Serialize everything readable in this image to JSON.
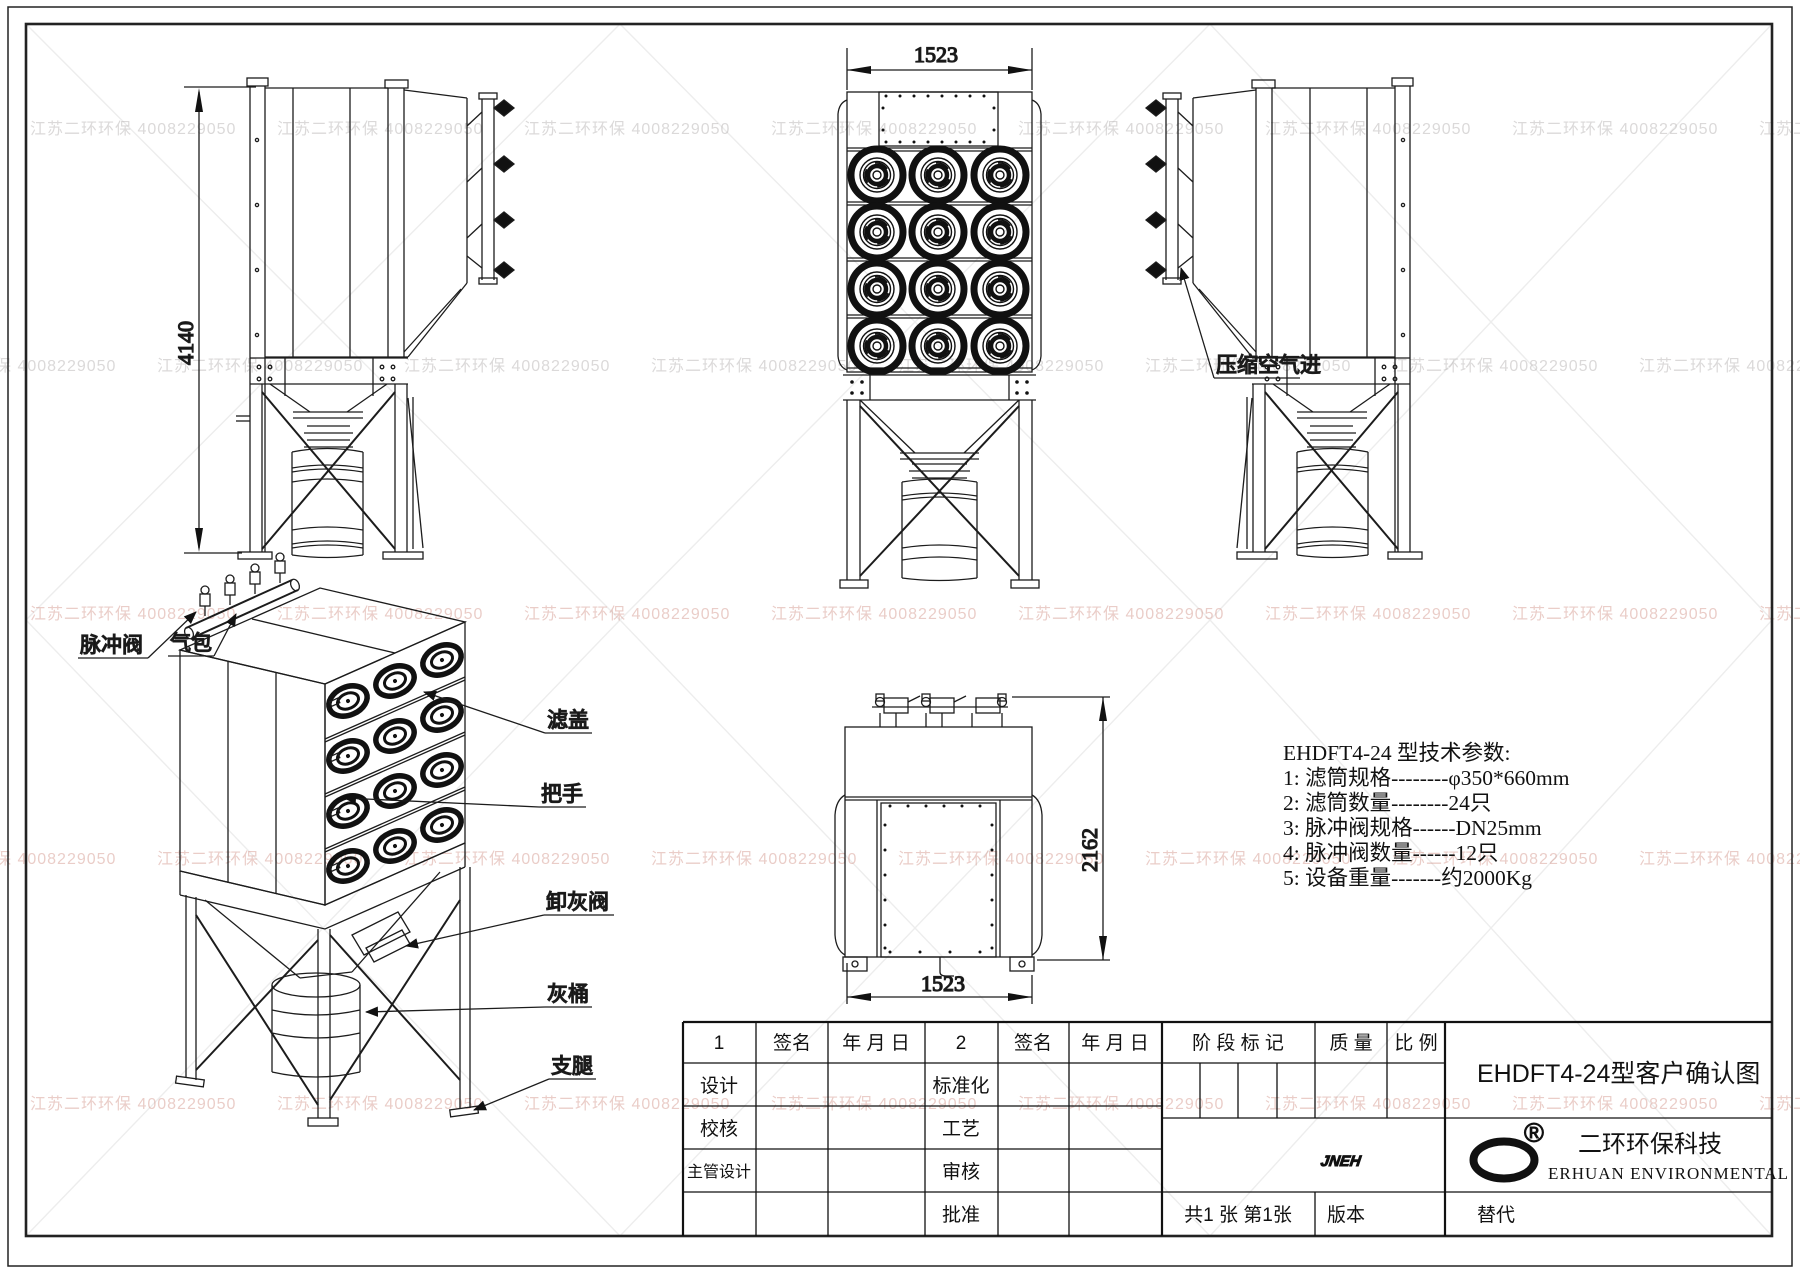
{
  "watermark": {
    "text": "江苏二环环保  4008229050"
  },
  "dims": {
    "left_height": "4140",
    "front_width": "1523",
    "rear_height": "2162",
    "rear_width": "1523"
  },
  "labels": {
    "air_inlet": "压缩空气进",
    "pulse_valve": "脉冲阀",
    "air_tank": "气包",
    "filter_cover": "滤盖",
    "handle": "把手",
    "ash_valve": "卸灰阀",
    "ash_bucket": "灰桶",
    "legs": "支腿"
  },
  "specs": {
    "title": "EHDFT4-24 型技术参数:",
    "item1": "1:  滤筒规格--------φ350*660mm",
    "item2": "2:  滤筒数量--------24只",
    "item3": "3:  脉冲阀规格------DN25mm",
    "item4": "4:  脉冲阀数量------12只",
    "item5": "5:  设备重量-------约2000Kg"
  },
  "titleblock": {
    "col1": "1",
    "sign": "签名",
    "date": "年 月 日",
    "col2": "2",
    "sign2": "签名",
    "date2": "年 月 日",
    "design": "设计",
    "standardize": "标准化",
    "check": "校核",
    "process": "工艺",
    "chief_design": "主管设计",
    "review": "审核",
    "approve": "批准",
    "stage_mark": "阶 段 标 记",
    "quality": "质 量",
    "scale": "比 例",
    "drawing_title": "EHDFT4-24型客户确认图",
    "sheets": "共1 张  第1张",
    "version": "版本",
    "replace": "替代",
    "logo_text": "JNEH",
    "registered": "®",
    "company_cn": "二环环保科技",
    "company_en": "ERHUAN ENVIRONMENTAL"
  }
}
